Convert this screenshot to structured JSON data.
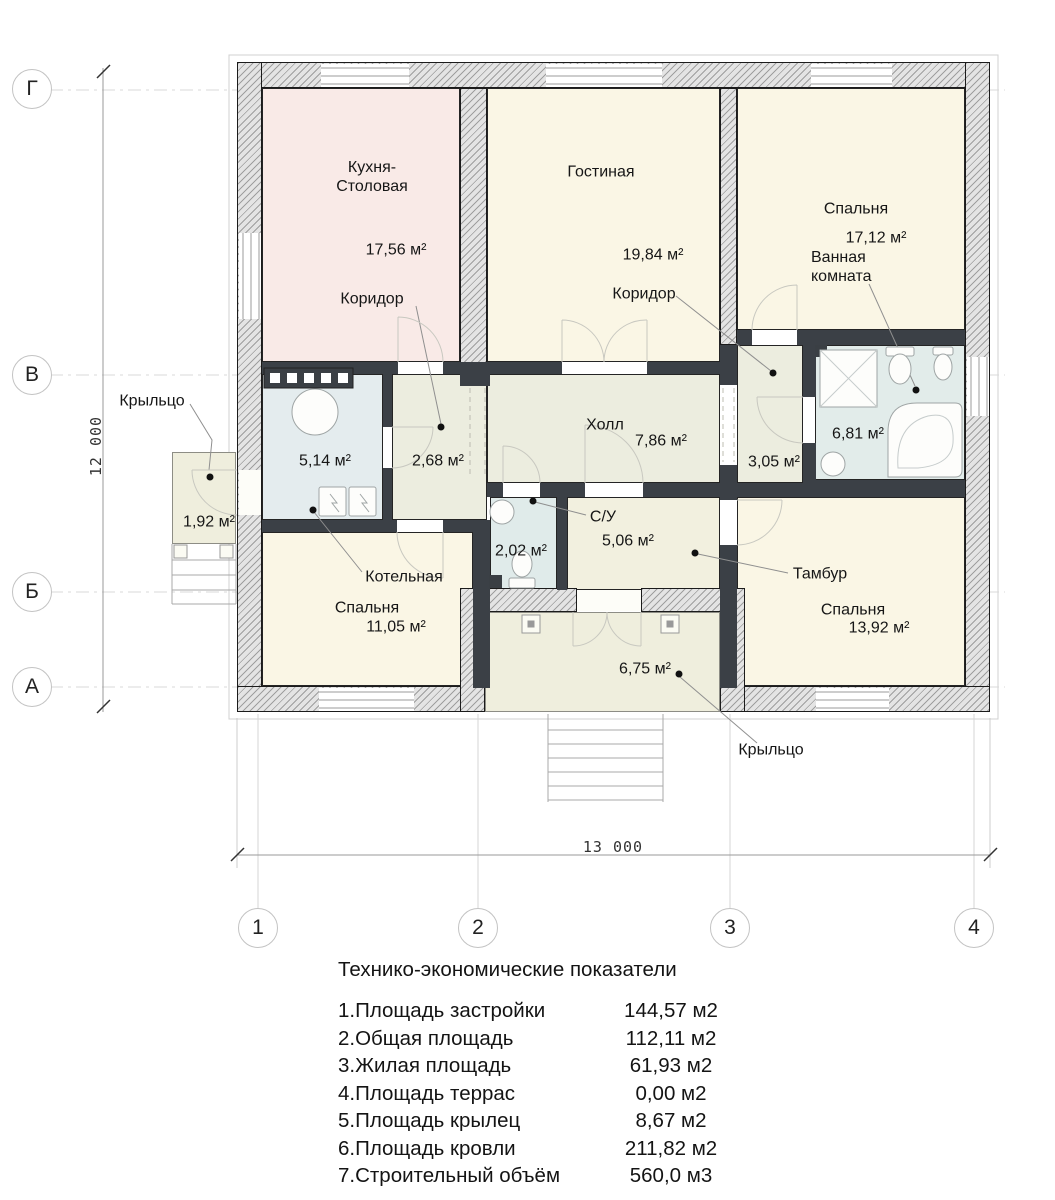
{
  "plan": {
    "rooms": [
      {
        "key": "kitchen-dining",
        "label": "Кухня-\nСтоловая",
        "area": "17,56 м²"
      },
      {
        "key": "living",
        "label": "Гостиная",
        "area": "19,84 м²"
      },
      {
        "key": "bedroom-top-right",
        "label": "Спальня",
        "area": "17,12 м²"
      },
      {
        "key": "bathroom",
        "label": "Ванная\nкомната",
        "area": "6,81 м²"
      },
      {
        "key": "corridor-left",
        "label": "Коридор",
        "area": "2,68 м²"
      },
      {
        "key": "corridor-right",
        "label": "Коридор",
        "area": "3,05 м²"
      },
      {
        "key": "hall",
        "label": "Холл",
        "area": "7,86 м²"
      },
      {
        "key": "boiler-room",
        "label": "Котельная",
        "area": "5,14 м²"
      },
      {
        "key": "wc",
        "label": "С/У",
        "area": "2,02 м²"
      },
      {
        "key": "tambour",
        "label": "Тамбур",
        "area": "5,06 м²"
      },
      {
        "key": "bedroom-bottom-left",
        "label": "Спальня",
        "area": "11,05 м²"
      },
      {
        "key": "bedroom-bottom-right",
        "label": "Спальня",
        "area": "13,92 м²"
      },
      {
        "key": "porch-left",
        "label": "Крыльцо",
        "area": "1,92 м²"
      },
      {
        "key": "porch-bottom",
        "label": "Крыльцо",
        "area": "6,75 м²"
      }
    ],
    "axes": {
      "rows": [
        "Г",
        "В",
        "Б",
        "А"
      ],
      "cols": [
        "1",
        "2",
        "3",
        "4"
      ]
    },
    "dimensions": {
      "horizontal": "13 000",
      "vertical": "12 000"
    }
  },
  "table": {
    "title": "Технико-экономические показатели",
    "rows": [
      {
        "label": "1.Площадь застройки",
        "value": "144,57 м2"
      },
      {
        "label": "2.Общая площадь",
        "value": "112,11 м2"
      },
      {
        "label": "3.Жилая площадь",
        "value": "61,93 м2"
      },
      {
        "label": "4.Площадь террас",
        "value": "0,00 м2"
      },
      {
        "label": "5.Площадь крылец",
        "value": "8,67 м2"
      },
      {
        "label": "6.Площадь кровли",
        "value": "211,82 м2"
      },
      {
        "label": "7.Строительный объём",
        "value": "560,0 м3"
      }
    ]
  }
}
